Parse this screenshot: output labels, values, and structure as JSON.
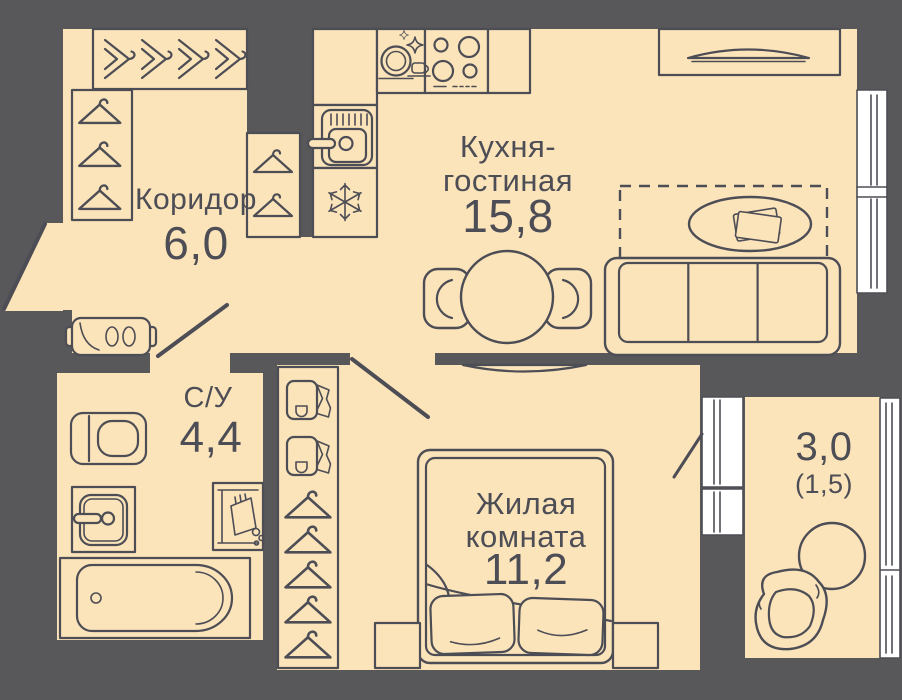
{
  "plan": {
    "colors": {
      "floor": "#fce4ba",
      "wall": "#58585a",
      "line": "#4d4d55",
      "window": "#ffffff"
    },
    "rooms": {
      "corridor": {
        "name": "Коридор",
        "area": "6,0"
      },
      "kitchen_living": {
        "name_line1": "Кухня-",
        "name_line2": "гостиная",
        "area": "15,8"
      },
      "bathroom": {
        "name": "С/У",
        "area": "4,4"
      },
      "bedroom": {
        "name_line1": "Жилая",
        "name_line2": "комната",
        "area": "11,2"
      },
      "balcony": {
        "area": "3,0",
        "area_secondary": "(1,5)"
      }
    }
  }
}
